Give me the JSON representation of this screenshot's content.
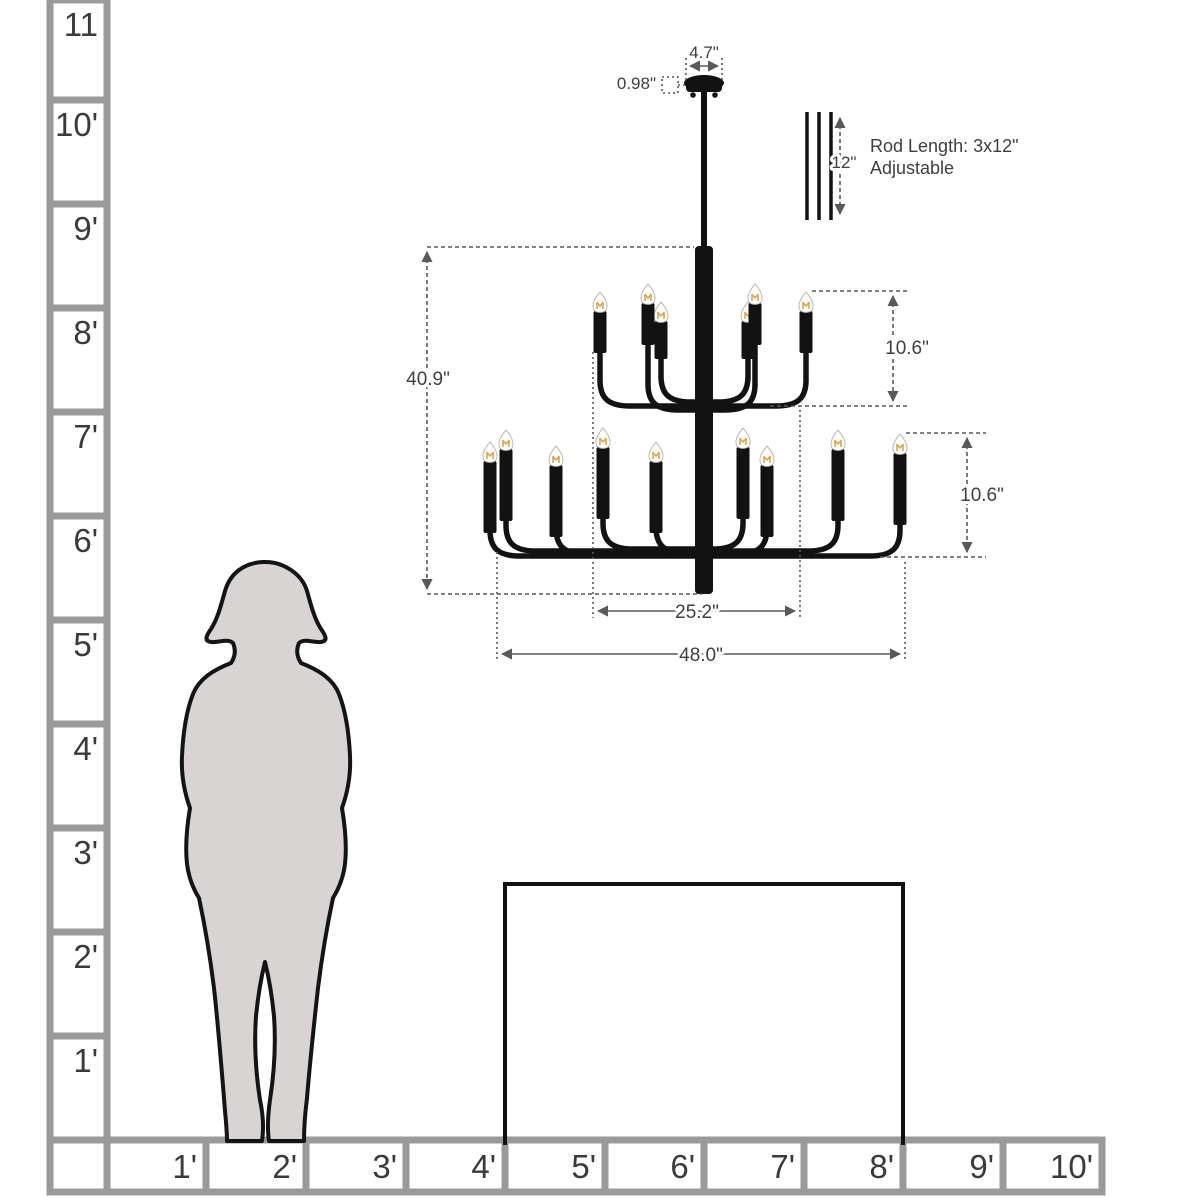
{
  "ruler": {
    "left_labels": [
      "11",
      "10'",
      "9'",
      "8'",
      "7'",
      "6'",
      "5'",
      "4'",
      "3'",
      "2'",
      "1'"
    ],
    "bottom_labels": [
      "1'",
      "2'",
      "3'",
      "4'",
      "5'",
      "6'",
      "7'",
      "8'",
      "9'",
      "10'"
    ]
  },
  "chandelier": {
    "dimensions": {
      "canopy_width": "4.7\"",
      "canopy_height": "0.98\"",
      "rod_segment_length": "12\"",
      "rod_note_line1": "Rod Length: 3x12\"",
      "rod_note_line2": "Adjustable",
      "overall_height": "40.9\"",
      "upper_tier_height": "10.6\"",
      "lower_tier_height": "10.6\"",
      "upper_tier_width": "25.2\"",
      "overall_width": "48.0\""
    },
    "colors": {
      "fixture": "#121212",
      "bulb_filament": "#d8a552"
    }
  },
  "scene": {
    "colors": {
      "background": "#ffffff",
      "grid_line": "#9a9a9a",
      "label_text": "#3a3a3a",
      "dimension_line": "#595959",
      "dimension_text": "#3f3f3f",
      "figure_fill": "#d7d4d3",
      "figure_outline": "#141414",
      "table_outline": "#111111"
    }
  }
}
